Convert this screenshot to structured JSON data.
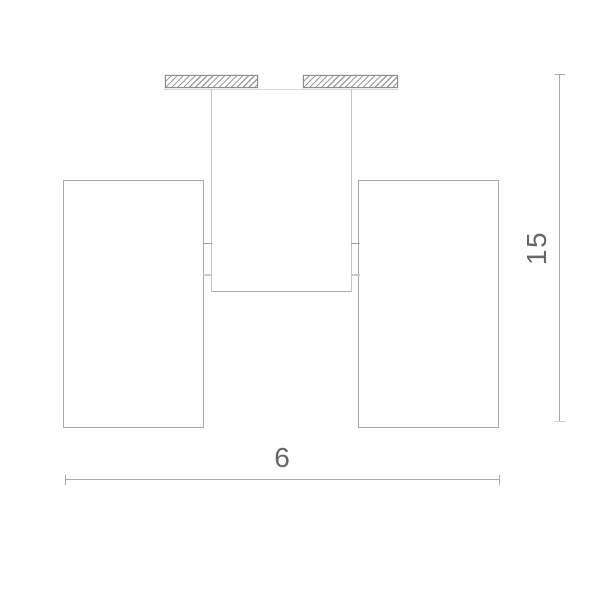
{
  "drawing": {
    "kind": "technical-dimension-drawing",
    "subject": "ceiling-spotlight-fixture-front-elevation",
    "parts": [
      "left-mount-plate-hatched",
      "right-mount-plate-hatched",
      "ceiling-line",
      "central-mount-body",
      "left-lamp-cylinder",
      "right-lamp-cylinder",
      "joint-ticks"
    ],
    "dimension_labels": {
      "width": "6",
      "height": "15"
    },
    "colors": {
      "background": "#ffffff",
      "lamp_outline": "#a8a8a8",
      "body_outline": "#c4c6c6",
      "ceiling_line": "#d8d8d8",
      "plate_border": "#8d8d8d",
      "hatch_line": "#9c9c9c",
      "dimension_line": "#ababab",
      "label_text": "#666666"
    }
  }
}
